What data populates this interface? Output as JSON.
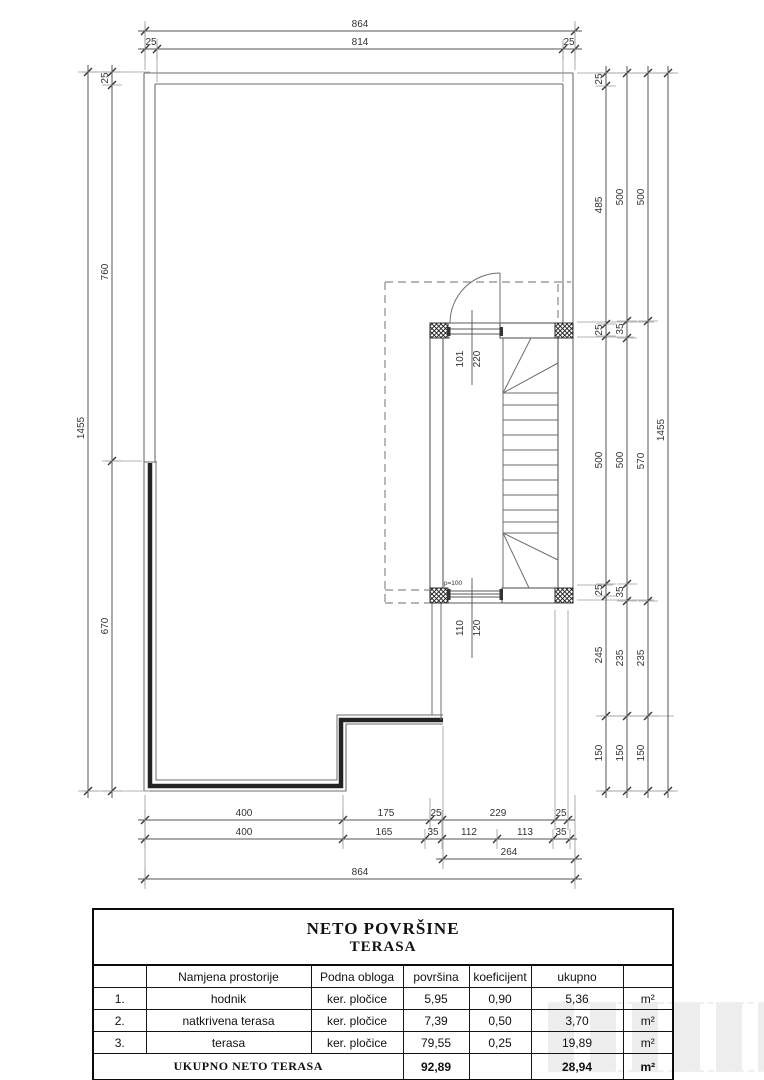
{
  "colors": {
    "line": "#6e6e6e",
    "thick_wall": "#232323",
    "dim_line": "#555555",
    "dashed": "#8a8a8a",
    "table_border": "#0d0d0d",
    "text": "#1a1a1a"
  },
  "drawing": {
    "dims_h": [
      {
        "y": 31,
        "ticks": [
          145,
          575
        ],
        "labels": [
          {
            "t": "864",
            "x": 360
          }
        ]
      },
      {
        "y": 49,
        "ticks": [
          145,
          157,
          563,
          575
        ],
        "labels": [
          {
            "t": "25",
            "x": 151
          },
          {
            "t": "814",
            "x": 360
          },
          {
            "t": "25",
            "x": 569
          }
        ]
      },
      {
        "y": 820,
        "ticks": [
          145,
          343,
          430,
          442,
          555,
          568
        ],
        "labels": [
          {
            "t": "400",
            "x": 244
          },
          {
            "t": "175",
            "x": 386
          },
          {
            "t": "25",
            "x": 436
          },
          {
            "t": "229",
            "x": 498
          },
          {
            "t": "25",
            "x": 561
          }
        ]
      },
      {
        "y": 839,
        "ticks": [
          145,
          343,
          425,
          442,
          497,
          553,
          570
        ],
        "labels": [
          {
            "t": "400",
            "x": 244
          },
          {
            "t": "165",
            "x": 384
          },
          {
            "t": "35",
            "x": 433
          },
          {
            "t": "112",
            "x": 469
          },
          {
            "t": "113",
            "x": 525
          },
          {
            "t": "35",
            "x": 561
          }
        ]
      },
      {
        "y": 859,
        "ticks": [
          443,
          575
        ],
        "labels": [
          {
            "t": "264",
            "x": 509
          }
        ]
      },
      {
        "y": 879,
        "ticks": [
          145,
          575
        ],
        "labels": [
          {
            "t": "864",
            "x": 360
          }
        ]
      }
    ],
    "dims_v": [
      {
        "x": 88,
        "ticks": [
          72,
          791
        ],
        "labels": [
          {
            "t": "1455",
            "y": 428
          }
        ]
      },
      {
        "x": 112,
        "ticks": [
          72,
          85,
          461,
          791
        ],
        "labels": [
          {
            "t": "25",
            "y": 78
          },
          {
            "t": "760",
            "y": 272
          },
          {
            "t": "670",
            "y": 626
          }
        ]
      },
      {
        "x": 606,
        "ticks": [
          73,
          86,
          324,
          336,
          584,
          596,
          716,
          791
        ],
        "labels": [
          {
            "t": "25",
            "y": 79
          },
          {
            "t": "485",
            "y": 205
          },
          {
            "t": "25",
            "y": 330
          },
          {
            "t": "500",
            "y": 460
          },
          {
            "t": "25",
            "y": 590
          },
          {
            "t": "245",
            "y": 655
          },
          {
            "t": "150",
            "y": 753
          }
        ]
      },
      {
        "x": 627,
        "ticks": [
          73,
          321,
          338,
          584,
          601,
          716,
          791
        ],
        "labels": [
          {
            "t": "500",
            "y": 197
          },
          {
            "t": "35",
            "y": 329
          },
          {
            "t": "500",
            "y": 460
          },
          {
            "t": "35",
            "y": 592
          },
          {
            "t": "235",
            "y": 658
          },
          {
            "t": "150",
            "y": 753
          }
        ]
      },
      {
        "x": 648,
        "ticks": [
          73,
          321,
          601,
          716,
          791
        ],
        "labels": [
          {
            "t": "500",
            "y": 197
          },
          {
            "t": "570",
            "y": 461
          },
          {
            "t": "235",
            "y": 658
          },
          {
            "t": "150",
            "y": 753
          }
        ]
      },
      {
        "x": 668,
        "ticks": [
          73,
          791
        ],
        "labels": [
          {
            "t": "1455",
            "y": 430
          }
        ]
      }
    ],
    "annotations": [
      {
        "t": "101",
        "x": 463,
        "y": 359,
        "rot": true,
        "size": 10
      },
      {
        "t": "220",
        "x": 480,
        "y": 359,
        "rot": true,
        "size": 10
      },
      {
        "t": "110",
        "x": 463,
        "y": 628,
        "rot": true,
        "size": 10
      },
      {
        "t": "120",
        "x": 480,
        "y": 628,
        "rot": true,
        "size": 10
      },
      {
        "t": "p=100",
        "x": 453,
        "y": 585,
        "rot": false,
        "size": 6.5
      }
    ]
  },
  "table": {
    "title_line1": "NETO POVRŠINE",
    "title_line2": "TERASA",
    "headers": [
      "",
      "Namjena prostorije",
      "Podna obloga",
      "površina",
      "koeficijent",
      "ukupno",
      ""
    ],
    "rows": [
      [
        "1.",
        "hodnik",
        "ker. pločice",
        "5,95",
        "0,90",
        "5,36",
        "m²"
      ],
      [
        "2.",
        "natkrivena terasa",
        "ker. pločice",
        "7,39",
        "0,50",
        "3,70",
        "m²"
      ],
      [
        "3.",
        "terasa",
        "ker. pločice",
        "79,55",
        "0,25",
        "19,89",
        "m²"
      ]
    ],
    "footer": {
      "label": "UKUPNO NETO TERASA",
      "povrsina": "92,89",
      "koeficijent": "",
      "ukupno": "28,94",
      "unit": "m²"
    }
  }
}
